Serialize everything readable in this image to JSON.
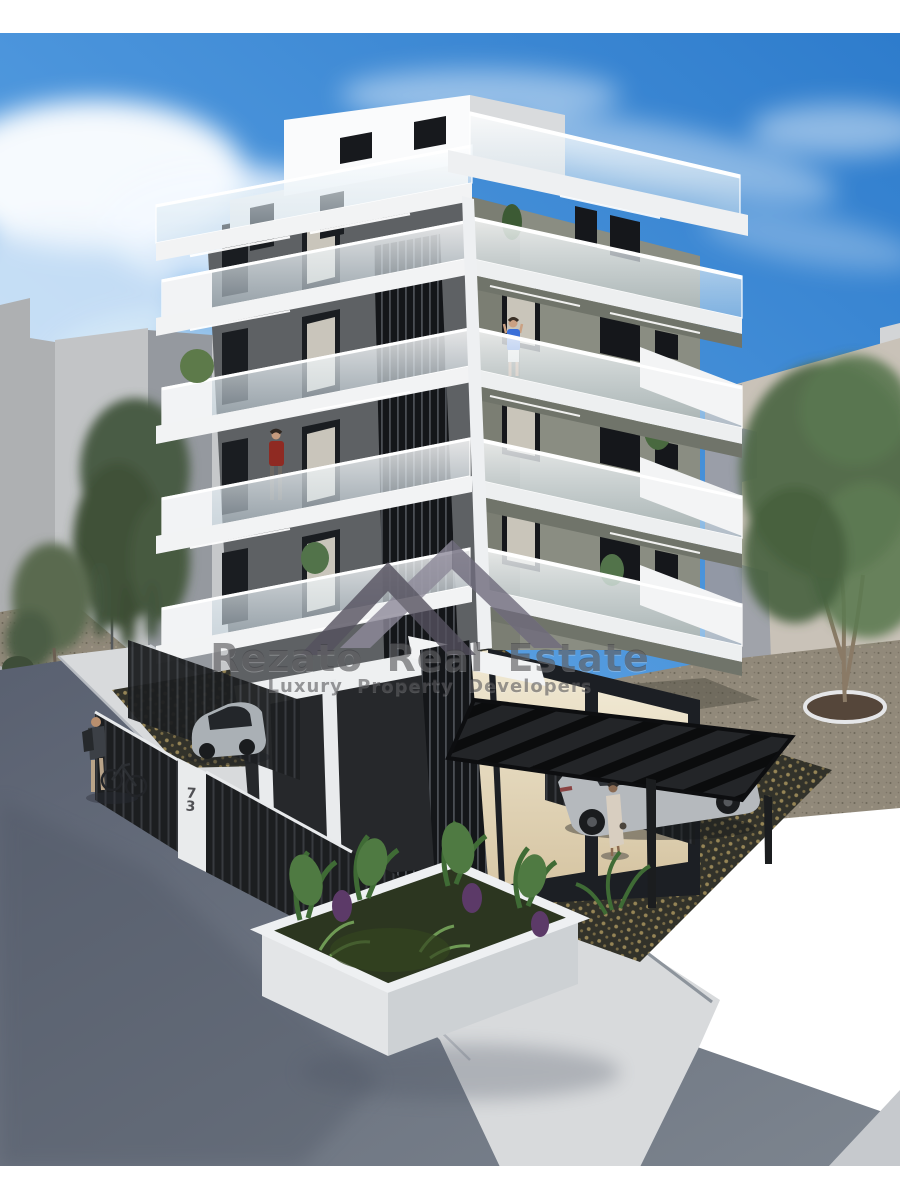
{
  "watermark": {
    "title": "Rezato Real Estate",
    "subtitle": "Luxury Property Developers",
    "logo_icon": "twin-roofs-logo-icon"
  },
  "property": {
    "street_number": "73"
  },
  "palette": {
    "sky_top": "#2e7ccc",
    "sky_light": "#7ab4e8",
    "white_facade": "#f2f3f4",
    "dark_wall": "#5e6164",
    "olive_wall": "#8a8d82",
    "louver_black": "#17191c",
    "glass_tint": "#dcebf5",
    "neighbor_gray": "#b6b8ba",
    "neighbor_beige": "#c9c2b8",
    "shadow_blue": "#8e95a4",
    "asphalt": "#6b7380",
    "sidewalk": "#d8dadc",
    "paving_dark": "#32322a",
    "paving_dot_gold": "#a8945e",
    "gravel": "#91897a",
    "foliage": "#4f6847",
    "planter_white": "#e6e8ea",
    "car_silver": "#aab0b5",
    "person_red_top": "#8f2a22",
    "person_blue_top": "#3a6fd8",
    "interior_warm": "#e7dcc2"
  }
}
